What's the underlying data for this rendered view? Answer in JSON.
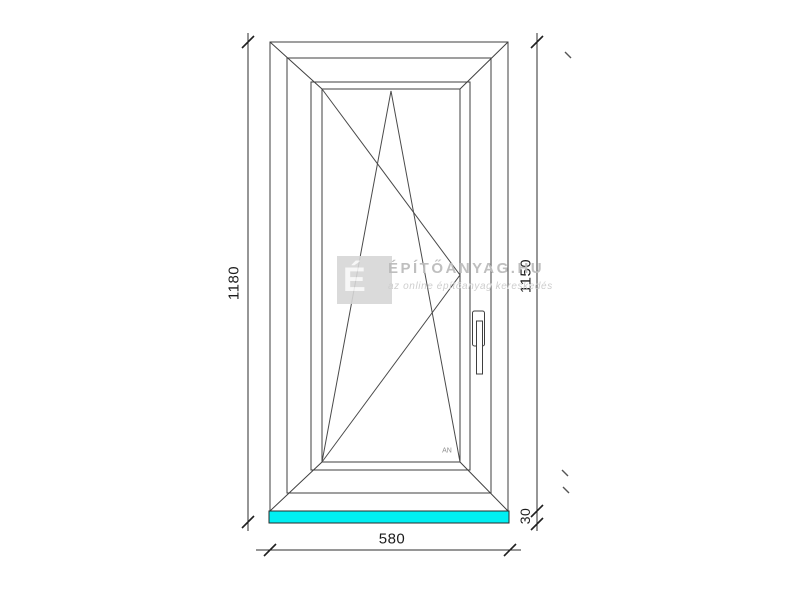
{
  "drawing": {
    "dim_total_height": "1180",
    "dim_window_height": "1150",
    "dim_sill_height": "30",
    "dim_width": "580",
    "opening_label": "AN",
    "sill_color": "#00EFF2",
    "line_color": "#3f3f3f"
  },
  "watermark": {
    "logo_letter": "É",
    "title": "ÉPÍTŐANYAG.HU",
    "subtitle": "az online építőanyag kereskedés"
  }
}
